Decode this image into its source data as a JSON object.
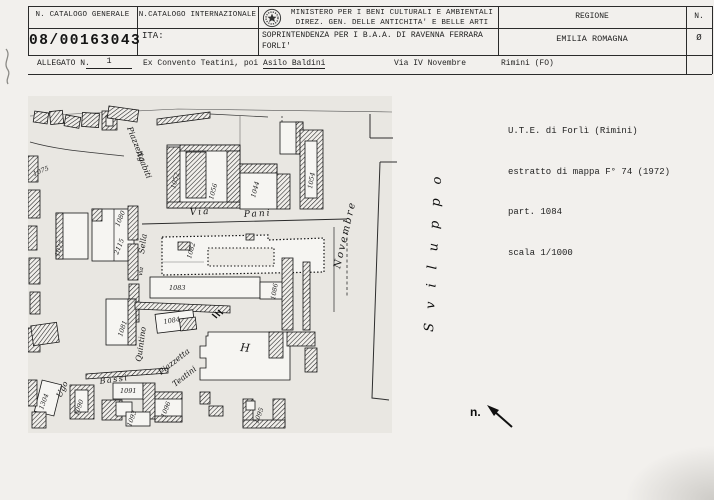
{
  "header": {
    "row1": {
      "col1": "N. CATALOGO GENERALE",
      "col2": "N.CATALOGO INTERNAZIONALE",
      "ministry_line1": "MINISTERO PER I BENI CULTURALI E AMBIENTALI",
      "ministry_line2": "DIREZ. GEN. DELLE ANTICHITA' E BELLE ARTI",
      "regione_label": "REGIONE",
      "n_label": "N."
    },
    "row2": {
      "catalog_number": "08/00163043",
      "ita_label": "ITA:",
      "soprintendenza_line1": "SOPRINTENDENZA PER I B.A.A. DI RAVENNA FERRARA",
      "soprintendenza_line2": "FORLI'",
      "regione_value": "EMILIA ROMAGNA",
      "n_value": "Ø"
    },
    "row3": {
      "allegato_label": "ALLEGATO N.",
      "allegato_value": "1",
      "title_prefix": "Ex Convento Teatini, poi ",
      "title_underlined": "Asilo Baldini",
      "street": "Via IV Novembre",
      "city": "Rimini (FO)"
    }
  },
  "note": {
    "line1": "U.T.E. di Forlì (Rimini)",
    "line2": "estratto di mappa F° 74 (1972)",
    "line3": "part. 1084",
    "line4": "scala 1/1000"
  },
  "map": {
    "sviluppo_label": "Sviluppo",
    "north_label": "n.",
    "street_labels": [
      {
        "t": "Piazzetta",
        "x": 99,
        "y": 34,
        "r": 68,
        "s": 8
      },
      {
        "t": "Agabiti",
        "x": 108,
        "y": 58,
        "r": 68,
        "s": 8
      },
      {
        "t": "Via",
        "x": 162,
        "y": 121,
        "r": -3,
        "s": 9,
        "ls": 2
      },
      {
        "t": "Pani",
        "x": 216,
        "y": 123,
        "r": -3,
        "s": 9,
        "ls": 2
      },
      {
        "t": "Sella",
        "x": 116,
        "y": 160,
        "r": -82,
        "s": 8
      },
      {
        "t": "via",
        "x": 114,
        "y": 182,
        "r": -82,
        "s": 6
      },
      {
        "t": "Quintino",
        "x": 113,
        "y": 268,
        "r": -82,
        "s": 8
      },
      {
        "t": "Piazzetta",
        "x": 133,
        "y": 281,
        "r": -38,
        "s": 8
      },
      {
        "t": "Teatini",
        "x": 147,
        "y": 293,
        "r": -38,
        "s": 8
      },
      {
        "t": "Ugo",
        "x": 33,
        "y": 304,
        "r": -65,
        "s": 8
      },
      {
        "t": "Bassi",
        "x": 72,
        "y": 290,
        "r": -8,
        "s": 8,
        "ls": 1.5
      },
      {
        "t": "Novembre",
        "x": 312,
        "y": 175,
        "r": -77,
        "s": 10,
        "ls": 2
      },
      {
        "t": "H",
        "x": 212,
        "y": 257,
        "r": 5,
        "s": 11
      }
    ],
    "parcel_labels": [
      {
        "t": "1075",
        "x": 6,
        "y": 82,
        "r": -22,
        "s": 6.5
      },
      {
        "t": "1077",
        "x": 31,
        "y": 163,
        "r": -72,
        "s": 6.5
      },
      {
        "t": "1080",
        "x": 91,
        "y": 133,
        "r": -68,
        "s": 6.5
      },
      {
        "t": "2115",
        "x": 90,
        "y": 161,
        "r": -68,
        "s": 6.5
      },
      {
        "t": "1081",
        "x": 94,
        "y": 243,
        "r": -72,
        "s": 6.5
      },
      {
        "t": "1052",
        "x": 147,
        "y": 95,
        "r": -75,
        "s": 6.5
      },
      {
        "t": "1056",
        "x": 185,
        "y": 106,
        "r": -75,
        "s": 6.5
      },
      {
        "t": "1044",
        "x": 227,
        "y": 104,
        "r": -75,
        "s": 6.5
      },
      {
        "t": "1054",
        "x": 284,
        "y": 95,
        "r": -80,
        "s": 6.5
      },
      {
        "t": "1082",
        "x": 163,
        "y": 165,
        "r": -75,
        "s": 6.5
      },
      {
        "t": "1083",
        "x": 141,
        "y": 196,
        "r": 0,
        "s": 6.5
      },
      {
        "t": "1084",
        "x": 136,
        "y": 230,
        "r": -10,
        "s": 6.5
      },
      {
        "t": "1086",
        "x": 247,
        "y": 206,
        "r": -80,
        "s": 6.5
      },
      {
        "t": "1304",
        "x": 15,
        "y": 316,
        "r": -70,
        "s": 6.5
      },
      {
        "t": "1090",
        "x": 50,
        "y": 322,
        "r": -70,
        "s": 6.5
      },
      {
        "t": "1091",
        "x": 92,
        "y": 299,
        "r": 0,
        "s": 6.5
      },
      {
        "t": "1093",
        "x": 103,
        "y": 333,
        "r": -70,
        "s": 6.5
      },
      {
        "t": "1096",
        "x": 137,
        "y": 324,
        "r": -70,
        "s": 6.5
      },
      {
        "t": "1095",
        "x": 230,
        "y": 330,
        "r": -70,
        "s": 6.5
      }
    ]
  }
}
